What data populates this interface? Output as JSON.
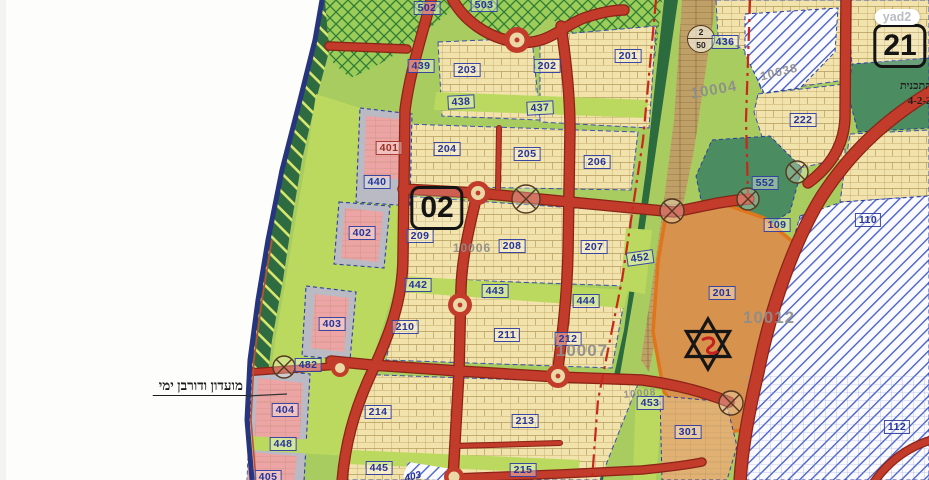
{
  "watermark": {
    "label": "yad2"
  },
  "road_marker": {
    "top": "2",
    "bottom": "50"
  },
  "annotations": {
    "left_note": "מועדון ודורבן ימי",
    "plan_text_line1": "ת התכנית",
    "plan_text_line2": "ת 4-2-2"
  },
  "map": {
    "colors": {
      "road_red": "#c23b2b",
      "parcel_cream": "#f2e2ab",
      "open_green": "#a8cc60",
      "strip_lime": "#bbd95f",
      "coast_dark_green": "#2e6b41",
      "public_green": "#4b8c60",
      "zone_pink": "#eca4a4",
      "zone_gray": "#b9bac4",
      "zone_orange": "#d7924d",
      "orange_border": "#e0761c",
      "label_blue": "#25349b",
      "plan_gray": "#8d8d8d",
      "hatch_blue": "#4a63c8",
      "boundary_dashdot_red": "#c8281c",
      "sea_line_blue": "#27357e"
    },
    "sheet_numbers": [
      "02",
      "21"
    ],
    "labels": [
      {
        "text": "502",
        "x": 427,
        "y": 8,
        "kind": "zone"
      },
      {
        "text": "503",
        "x": 484,
        "y": 5,
        "kind": "zone"
      },
      {
        "text": "439",
        "x": 421,
        "y": 66,
        "kind": "zone"
      },
      {
        "text": "203",
        "x": 467,
        "y": 70,
        "kind": "zone"
      },
      {
        "text": "202",
        "x": 547,
        "y": 66,
        "kind": "zone"
      },
      {
        "text": "201",
        "x": 628,
        "y": 56,
        "kind": "zone"
      },
      {
        "text": "436",
        "x": 725,
        "y": 42,
        "kind": "zone"
      },
      {
        "text": "438",
        "x": 461,
        "y": 102,
        "kind": "zone",
        "rot": -3
      },
      {
        "text": "437",
        "x": 540,
        "y": 108,
        "kind": "zone",
        "rot": -3
      },
      {
        "text": "222",
        "x": 803,
        "y": 120,
        "kind": "zone"
      },
      {
        "text": "552",
        "x": 765,
        "y": 183,
        "kind": "zone"
      },
      {
        "text": "401",
        "x": 389,
        "y": 148,
        "kind": "zone-red"
      },
      {
        "text": "440",
        "x": 377,
        "y": 182,
        "kind": "zone"
      },
      {
        "text": "204",
        "x": 447,
        "y": 149,
        "kind": "zone"
      },
      {
        "text": "205",
        "x": 527,
        "y": 154,
        "kind": "zone"
      },
      {
        "text": "206",
        "x": 597,
        "y": 162,
        "kind": "zone"
      },
      {
        "text": "402",
        "x": 362,
        "y": 233,
        "kind": "zone"
      },
      {
        "text": "209",
        "x": 420,
        "y": 236,
        "kind": "zone"
      },
      {
        "text": "208",
        "x": 512,
        "y": 246,
        "kind": "zone"
      },
      {
        "text": "207",
        "x": 594,
        "y": 247,
        "kind": "zone"
      },
      {
        "text": "452",
        "x": 640,
        "y": 258,
        "kind": "zone",
        "rot": -8
      },
      {
        "text": "442",
        "x": 418,
        "y": 285,
        "kind": "zone"
      },
      {
        "text": "443",
        "x": 495,
        "y": 291,
        "kind": "zone"
      },
      {
        "text": "444",
        "x": 586,
        "y": 301,
        "kind": "zone"
      },
      {
        "text": "109",
        "x": 777,
        "y": 225,
        "kind": "zone"
      },
      {
        "text": "201",
        "x": 722,
        "y": 293,
        "kind": "zone"
      },
      {
        "text": "403",
        "x": 332,
        "y": 324,
        "kind": "zone"
      },
      {
        "text": "210",
        "x": 405,
        "y": 327,
        "kind": "zone"
      },
      {
        "text": "211",
        "x": 507,
        "y": 335,
        "kind": "zone"
      },
      {
        "text": "212",
        "x": 568,
        "y": 339,
        "kind": "zone"
      },
      {
        "text": "482",
        "x": 308,
        "y": 365,
        "kind": "zone"
      },
      {
        "text": "404",
        "x": 285,
        "y": 410,
        "kind": "zone"
      },
      {
        "text": "214",
        "x": 378,
        "y": 412,
        "kind": "zone"
      },
      {
        "text": "213",
        "x": 525,
        "y": 421,
        "kind": "zone"
      },
      {
        "text": "448",
        "x": 283,
        "y": 444,
        "kind": "zone"
      },
      {
        "text": "445",
        "x": 379,
        "y": 468,
        "kind": "zone"
      },
      {
        "text": "405",
        "x": 268,
        "y": 477,
        "kind": "zone"
      },
      {
        "text": "215",
        "x": 523,
        "y": 470,
        "kind": "zone"
      },
      {
        "text": "453",
        "x": 650,
        "y": 403,
        "kind": "zone"
      },
      {
        "text": "301",
        "x": 688,
        "y": 432,
        "kind": "zone"
      },
      {
        "text": "110",
        "x": 868,
        "y": 220,
        "kind": "zone"
      },
      {
        "text": "112",
        "x": 897,
        "y": 427,
        "kind": "zone"
      },
      {
        "text": "403",
        "x": 413,
        "y": 477,
        "kind": "zone-plain",
        "rot": -14
      },
      {
        "text": "10004",
        "x": 714,
        "y": 90,
        "kind": "plannum",
        "size": 15,
        "rot": -10
      },
      {
        "text": "10038",
        "x": 779,
        "y": 72,
        "kind": "plannum",
        "size": 12,
        "rot": -14
      },
      {
        "text": "10006",
        "x": 472,
        "y": 248,
        "kind": "plannum",
        "size": 12
      },
      {
        "text": "10007",
        "x": 582,
        "y": 351,
        "kind": "plannum",
        "size": 17
      },
      {
        "text": "10012",
        "x": 769,
        "y": 318,
        "kind": "plannum",
        "size": 17
      },
      {
        "text": "10008",
        "x": 640,
        "y": 394,
        "kind": "plannum",
        "size": 10,
        "rot": -5
      },
      {
        "text": "02",
        "x": 437,
        "y": 208,
        "kind": "sheet"
      },
      {
        "text": "21",
        "x": 900,
        "y": 46,
        "kind": "sheet"
      },
      {
        "text": "yad2",
        "x": 897,
        "y": 17,
        "kind": "watermark"
      },
      {
        "text": "מועדון ודורבן ימי",
        "x": 247,
        "y": 387,
        "kind": "hebrew-note",
        "anchor": "end"
      },
      {
        "text": "ת התכנית",
        "x": 941,
        "y": 86,
        "kind": "hebrew-small",
        "anchor": "end"
      },
      {
        "text": "ת 4-2-2",
        "x": 941,
        "y": 101,
        "kind": "hebrew-small",
        "anchor": "end"
      }
    ]
  }
}
